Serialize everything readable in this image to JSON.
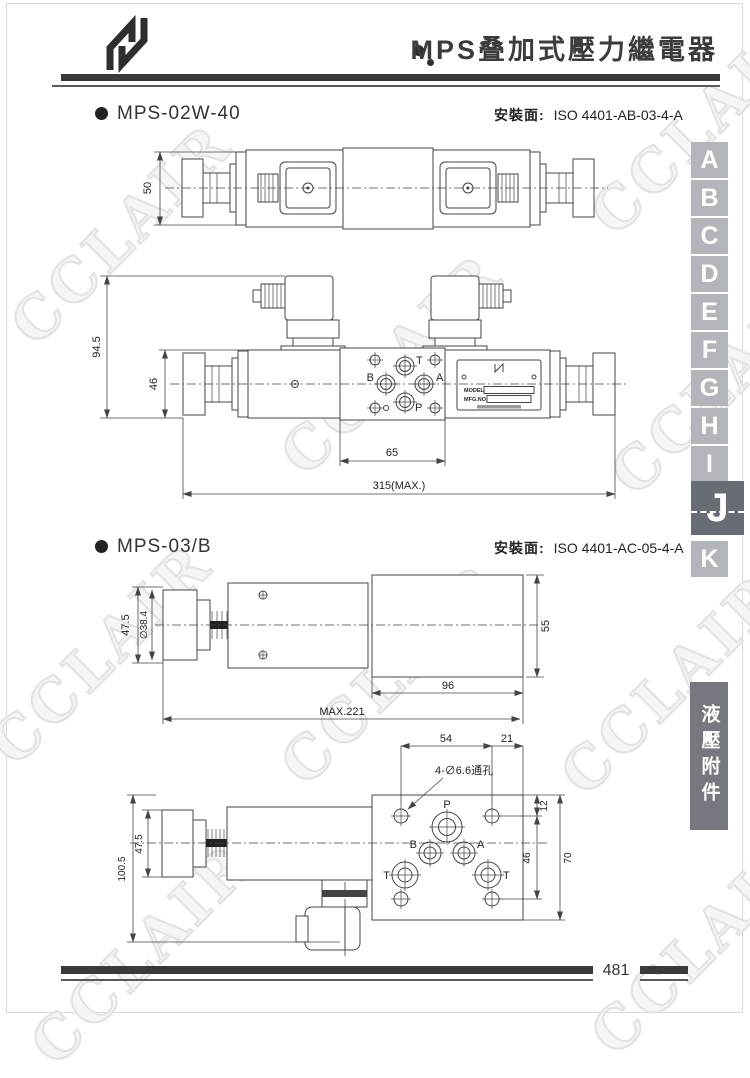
{
  "page": {
    "title": "MPS叠加式壓力繼電器",
    "page_number": "481",
    "watermark": "CCLAIR",
    "side_tab": "液壓附件"
  },
  "sections": [
    {
      "model": "MPS-02W-40",
      "mount_label": "安裝面:",
      "mount_value": "ISO 4401-AB-03-4-A"
    },
    {
      "model": "MPS-03/B",
      "mount_label": "安裝面:",
      "mount_value": "ISO 4401-AC-05-4-A"
    }
  ],
  "sidebar": {
    "tabs": [
      "A",
      "B",
      "C",
      "D",
      "E",
      "F",
      "G",
      "H",
      "I",
      "J",
      "K"
    ],
    "active": "J"
  },
  "drawing1": {
    "dims": {
      "height": "50"
    }
  },
  "drawing2": {
    "dims": {
      "total_height": "94.5",
      "body_height": "46",
      "port_span": "65",
      "total_length": "315(MAX.)"
    },
    "ports": {
      "top": "T",
      "left": "B",
      "right": "A",
      "bottom": "P"
    },
    "nameplate": {
      "line1": "MODEL",
      "line2": "MFG.NO."
    }
  },
  "drawing3": {
    "dims": {
      "knob_height": "47.5",
      "knob_dia": "∅38.4",
      "right_height": "55",
      "right_length": "96",
      "total_length": "MAX.221"
    }
  },
  "drawing4": {
    "dims": {
      "hole_span_x": "54",
      "edge_offset": "21",
      "top_offset": "12",
      "hole_span_y": "46",
      "plate_height": "70",
      "total_height": "100.5",
      "knob_height": "47.5"
    },
    "hole_note": "4-∅6.6通孔",
    "ports": {
      "p": "P",
      "b": "B",
      "a": "A",
      "t_left": "T",
      "t_right": "T"
    }
  }
}
